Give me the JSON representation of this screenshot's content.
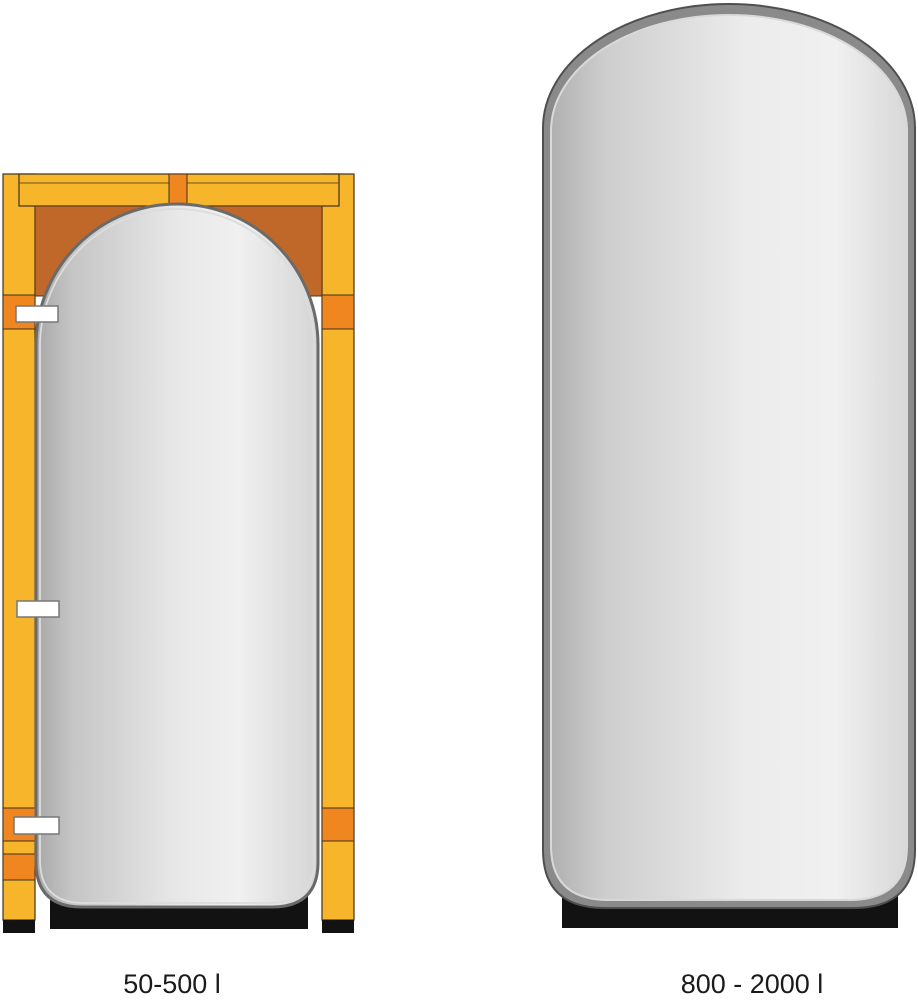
{
  "figure": {
    "title": "tank size comparison",
    "tanks": [
      {
        "label": "50-500 l",
        "style": "small tank packed in wooden transport frame"
      },
      {
        "label": "800 - 2000 l",
        "style": "large free-standing insulated tank"
      }
    ]
  },
  "labels": {
    "small": "50-500 l",
    "large": "800 - 2000 l"
  },
  "colors": {
    "background": "#ffffff",
    "frame_yellow": "#F7B52B",
    "frame_orange": "#EF861F",
    "frame_dark_orange": "#C0682A",
    "tank_dark": "#a7a7a7",
    "tank_light": "#f0f0f0",
    "shell_gray": "#8a8a8a",
    "base_black": "#121212",
    "stub_white": "#ffffff",
    "label_text": "#1a1a1a"
  }
}
